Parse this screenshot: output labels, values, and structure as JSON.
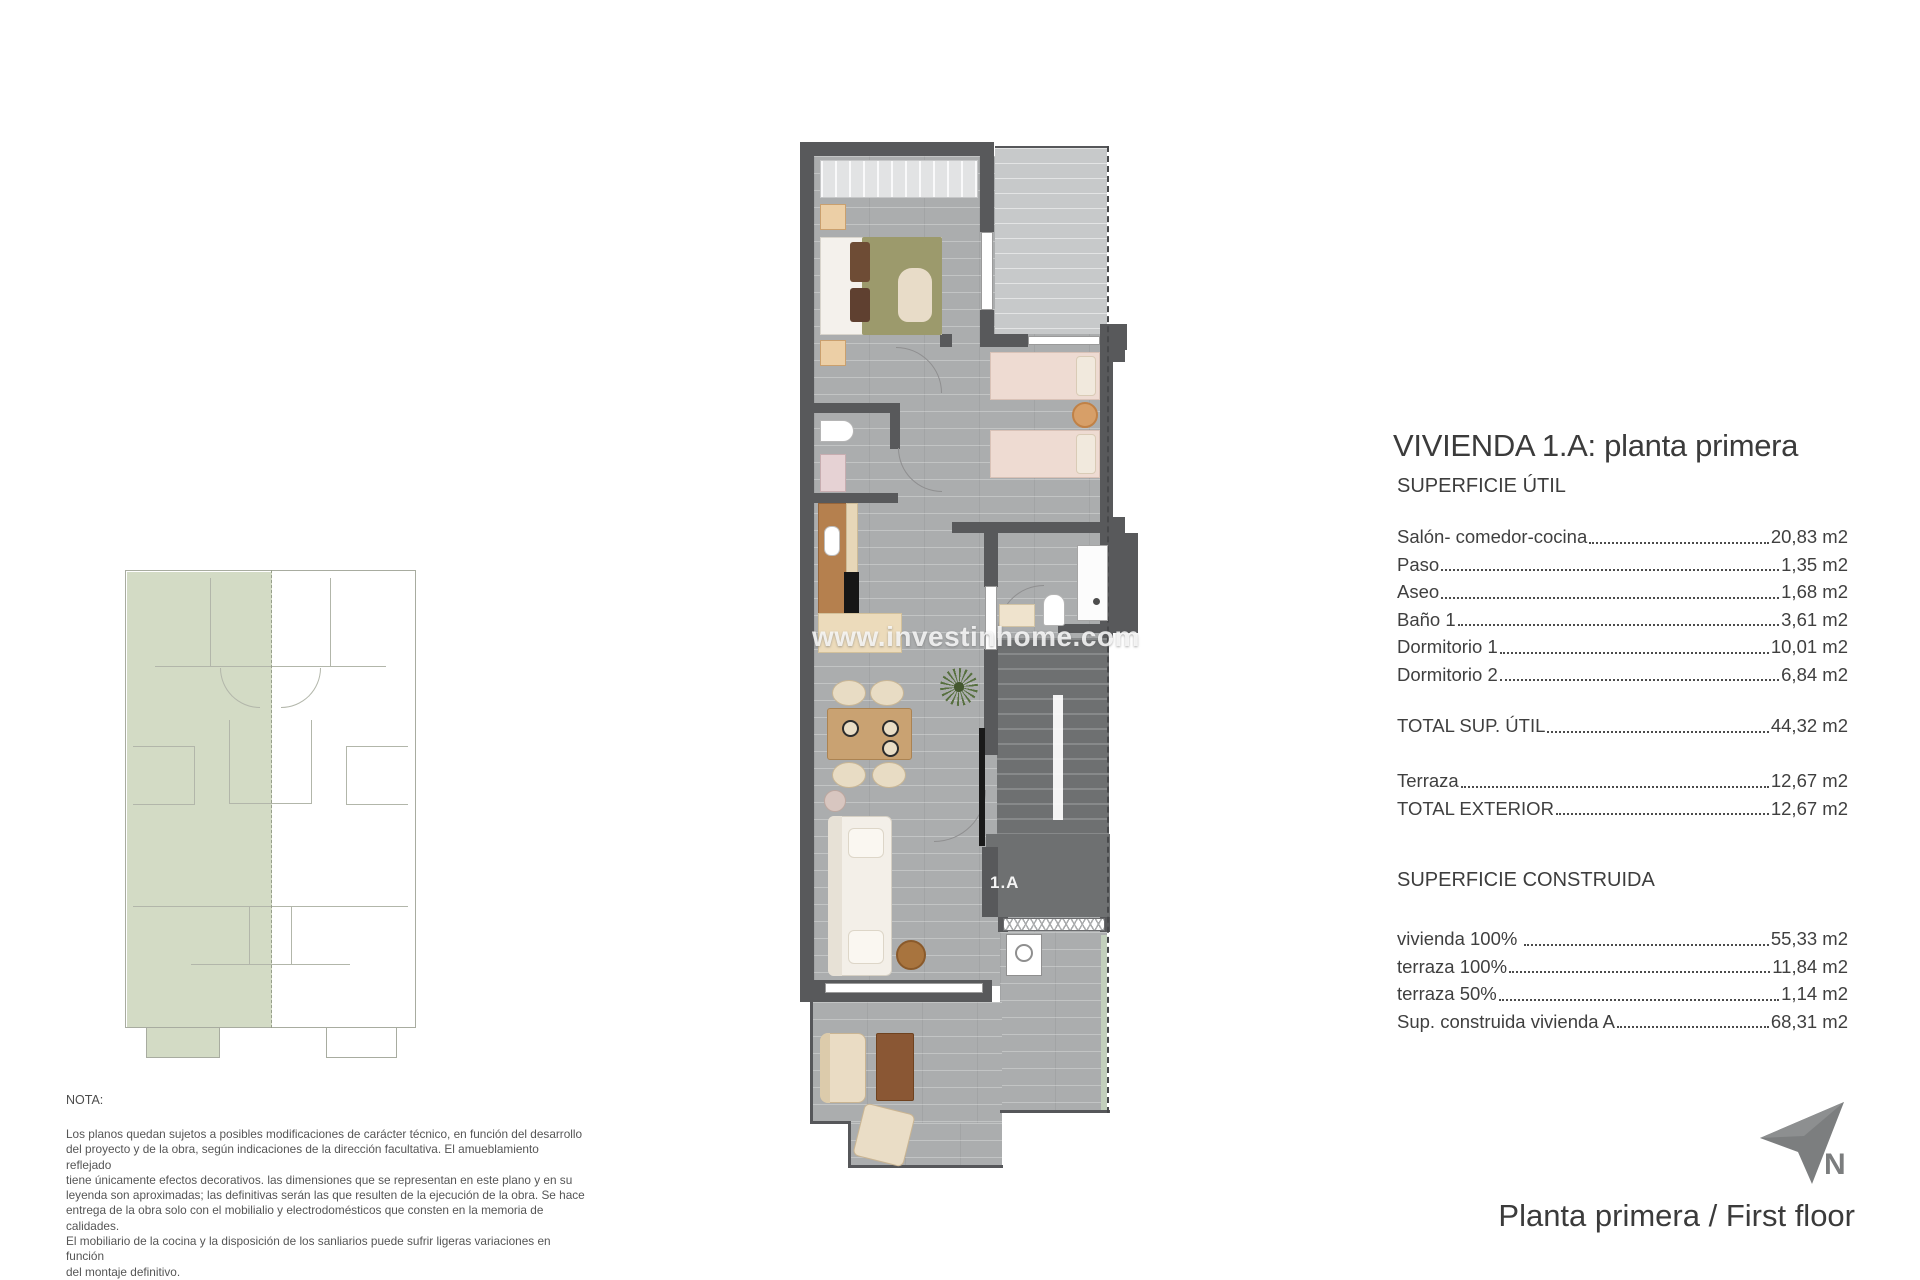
{
  "watermark": {
    "text": "www.investinhome.com"
  },
  "main_plan": {
    "unit_label": "1.A"
  },
  "panel": {
    "title": "VIVIENDA 1.A: planta primera",
    "superficie_util": {
      "heading": "SUPERFICIE ÚTIL",
      "rows": [
        {
          "label": "Salón- comedor-cocina",
          "value": "20,83 m2"
        },
        {
          "label": "Paso",
          "value": "1,35 m2"
        },
        {
          "label": "Aseo",
          "value": "1,68 m2"
        },
        {
          "label": "Baño 1",
          "value": "3,61 m2"
        },
        {
          "label": "Dormitorio 1",
          "value": "10,01 m2"
        },
        {
          "label": "Dormitorio 2",
          "value": "6,84 m2"
        }
      ],
      "total": {
        "label": "TOTAL SUP. ÚTIL",
        "value": "44,32 m2"
      }
    },
    "exterior": {
      "rows": [
        {
          "label": "Terraza",
          "value": "12,67 m2"
        },
        {
          "label": "TOTAL EXTERIOR",
          "value": "12,67 m2"
        }
      ]
    },
    "superficie_construida": {
      "heading": "SUPERFICIE CONSTRUIDA",
      "rows": [
        {
          "label": "vivienda 100% ",
          "value": "55,33 m2"
        },
        {
          "label": "terraza 100%",
          "value": "11,84 m2"
        },
        {
          "label": "terraza 50%",
          "value": "1,14 m2"
        },
        {
          "label": "Sup. construida vivienda A",
          "value": "68,31 m2"
        }
      ]
    }
  },
  "nota": {
    "heading": "NOTA:",
    "body": "Los planos quedan sujetos a posibles modificaciones de carácter técnico, en función del desarrollo\ndel proyecto y de la obra, según indicaciones de la dirección facultativa. El amueblamiento reflejado\ntiene únicamente efectos decorativos. las dimensiones que se representan en este plano y en su\nleyenda son aproximadas; las definitivas serán las que resulten de la ejecución de la obra. Se hace\nentrega de la obra solo con el mobilialio y electrodomésticos que consten en la memoria de calidades.\nEl mobiliario de la cocina y la disposición de los sanliarios puede sufrir ligeras variaciones en función\ndel montaje definitivo."
  },
  "compass": {
    "label": "N"
  },
  "footer": {
    "title": "Planta primera / First floor"
  },
  "colors": {
    "wall": "#58595b",
    "interior_floor": "#abadae",
    "terrace_floor": "#c7c9ca",
    "stair_floor": "#6e7071",
    "keyplan_green": "#d3dbc5"
  }
}
